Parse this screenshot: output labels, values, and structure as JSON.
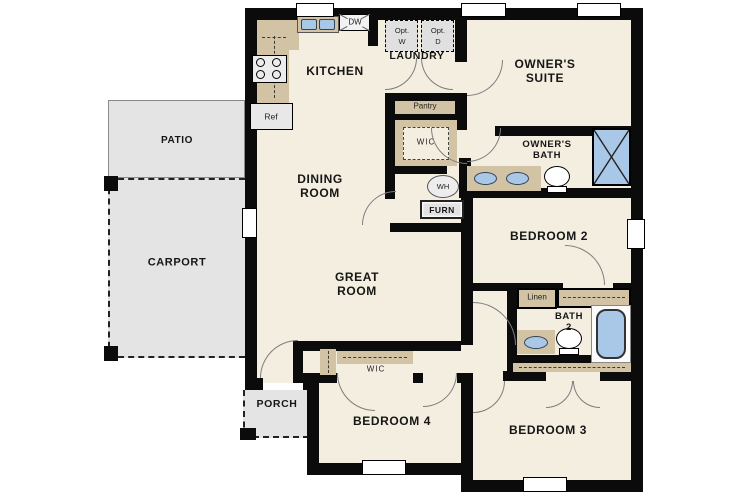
{
  "plan_title": "single-story floor plan",
  "labels": {
    "kitchen": "KITCHEN",
    "dining": [
      "DINING",
      "ROOM"
    ],
    "great": [
      "GREAT",
      "ROOM"
    ],
    "owners_suite": [
      "OWNER'S",
      "SUITE"
    ],
    "owners_bath": [
      "OWNER'S",
      "BATH"
    ],
    "bath2": [
      "BATH",
      "2"
    ],
    "laundry": "LAUNDRY",
    "bedroom2": "BEDROOM 2",
    "bedroom3": "BEDROOM 3",
    "bedroom4": "BEDROOM 4",
    "patio": "PATIO",
    "carport": "CARPORT",
    "porch": "PORCH",
    "wic_owner": "WIC",
    "wic_bedroom4": "WIC",
    "pantry": "Pantry",
    "linen": "Linen",
    "water_heater": "WH",
    "furnace": "FURN",
    "refrigerator": "Ref",
    "dishwasher": "DW",
    "optional_washer": [
      "Opt.",
      "W"
    ],
    "optional_dryer": [
      "Opt.",
      "D"
    ]
  },
  "colors": {
    "wall": "#0b0b0b",
    "floor": "#f4eee0",
    "cabinet_tan": "#d2c3a5",
    "outdoor_gray": "#e4e4e4",
    "fixture_blue": "#a9c7e7",
    "window_white": "#ffffff"
  }
}
